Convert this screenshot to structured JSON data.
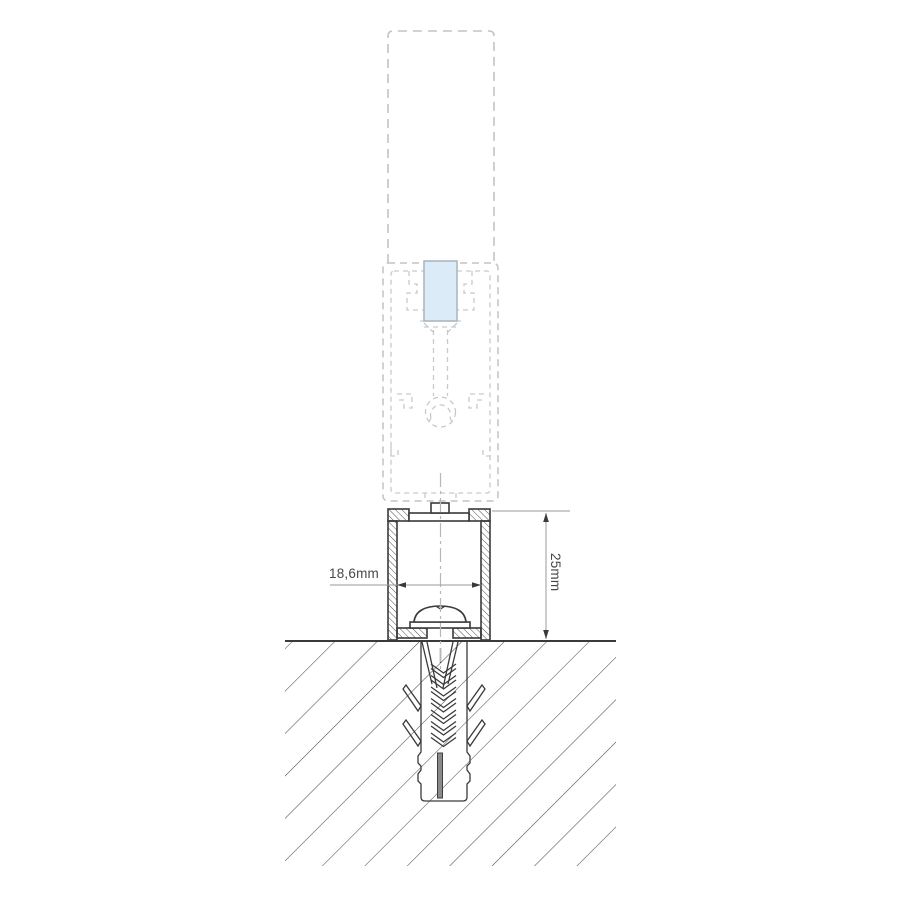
{
  "diagram": {
    "type": "technical-cross-section",
    "description": "Mounting detail of a glazing post base profile fixed to ground with screw and wall anchor",
    "labels": {
      "inner_width": "18,6mm",
      "profile_height": "25mm"
    },
    "colors": {
      "background": "#ffffff",
      "solid_line": "#3a3a3a",
      "hatch_line": "#4f4f4f",
      "dashed_outline": "#c0c4c8",
      "centerline": "#b4b8bc",
      "dimension_line": "#9a9a9a",
      "dimension_text": "#474747",
      "glass_fill": "#dcebf8",
      "glass_border": "#a9b4bc",
      "anchor_slot_fill": "#8a8a8a"
    },
    "parts": [
      "glass-panel-dashed-outline",
      "post-profile-dashed-section",
      "glass-insert",
      "base-profile",
      "pan-head-screw",
      "wall-anchor",
      "ground-hatch",
      "width-dimension",
      "height-dimension"
    ]
  }
}
